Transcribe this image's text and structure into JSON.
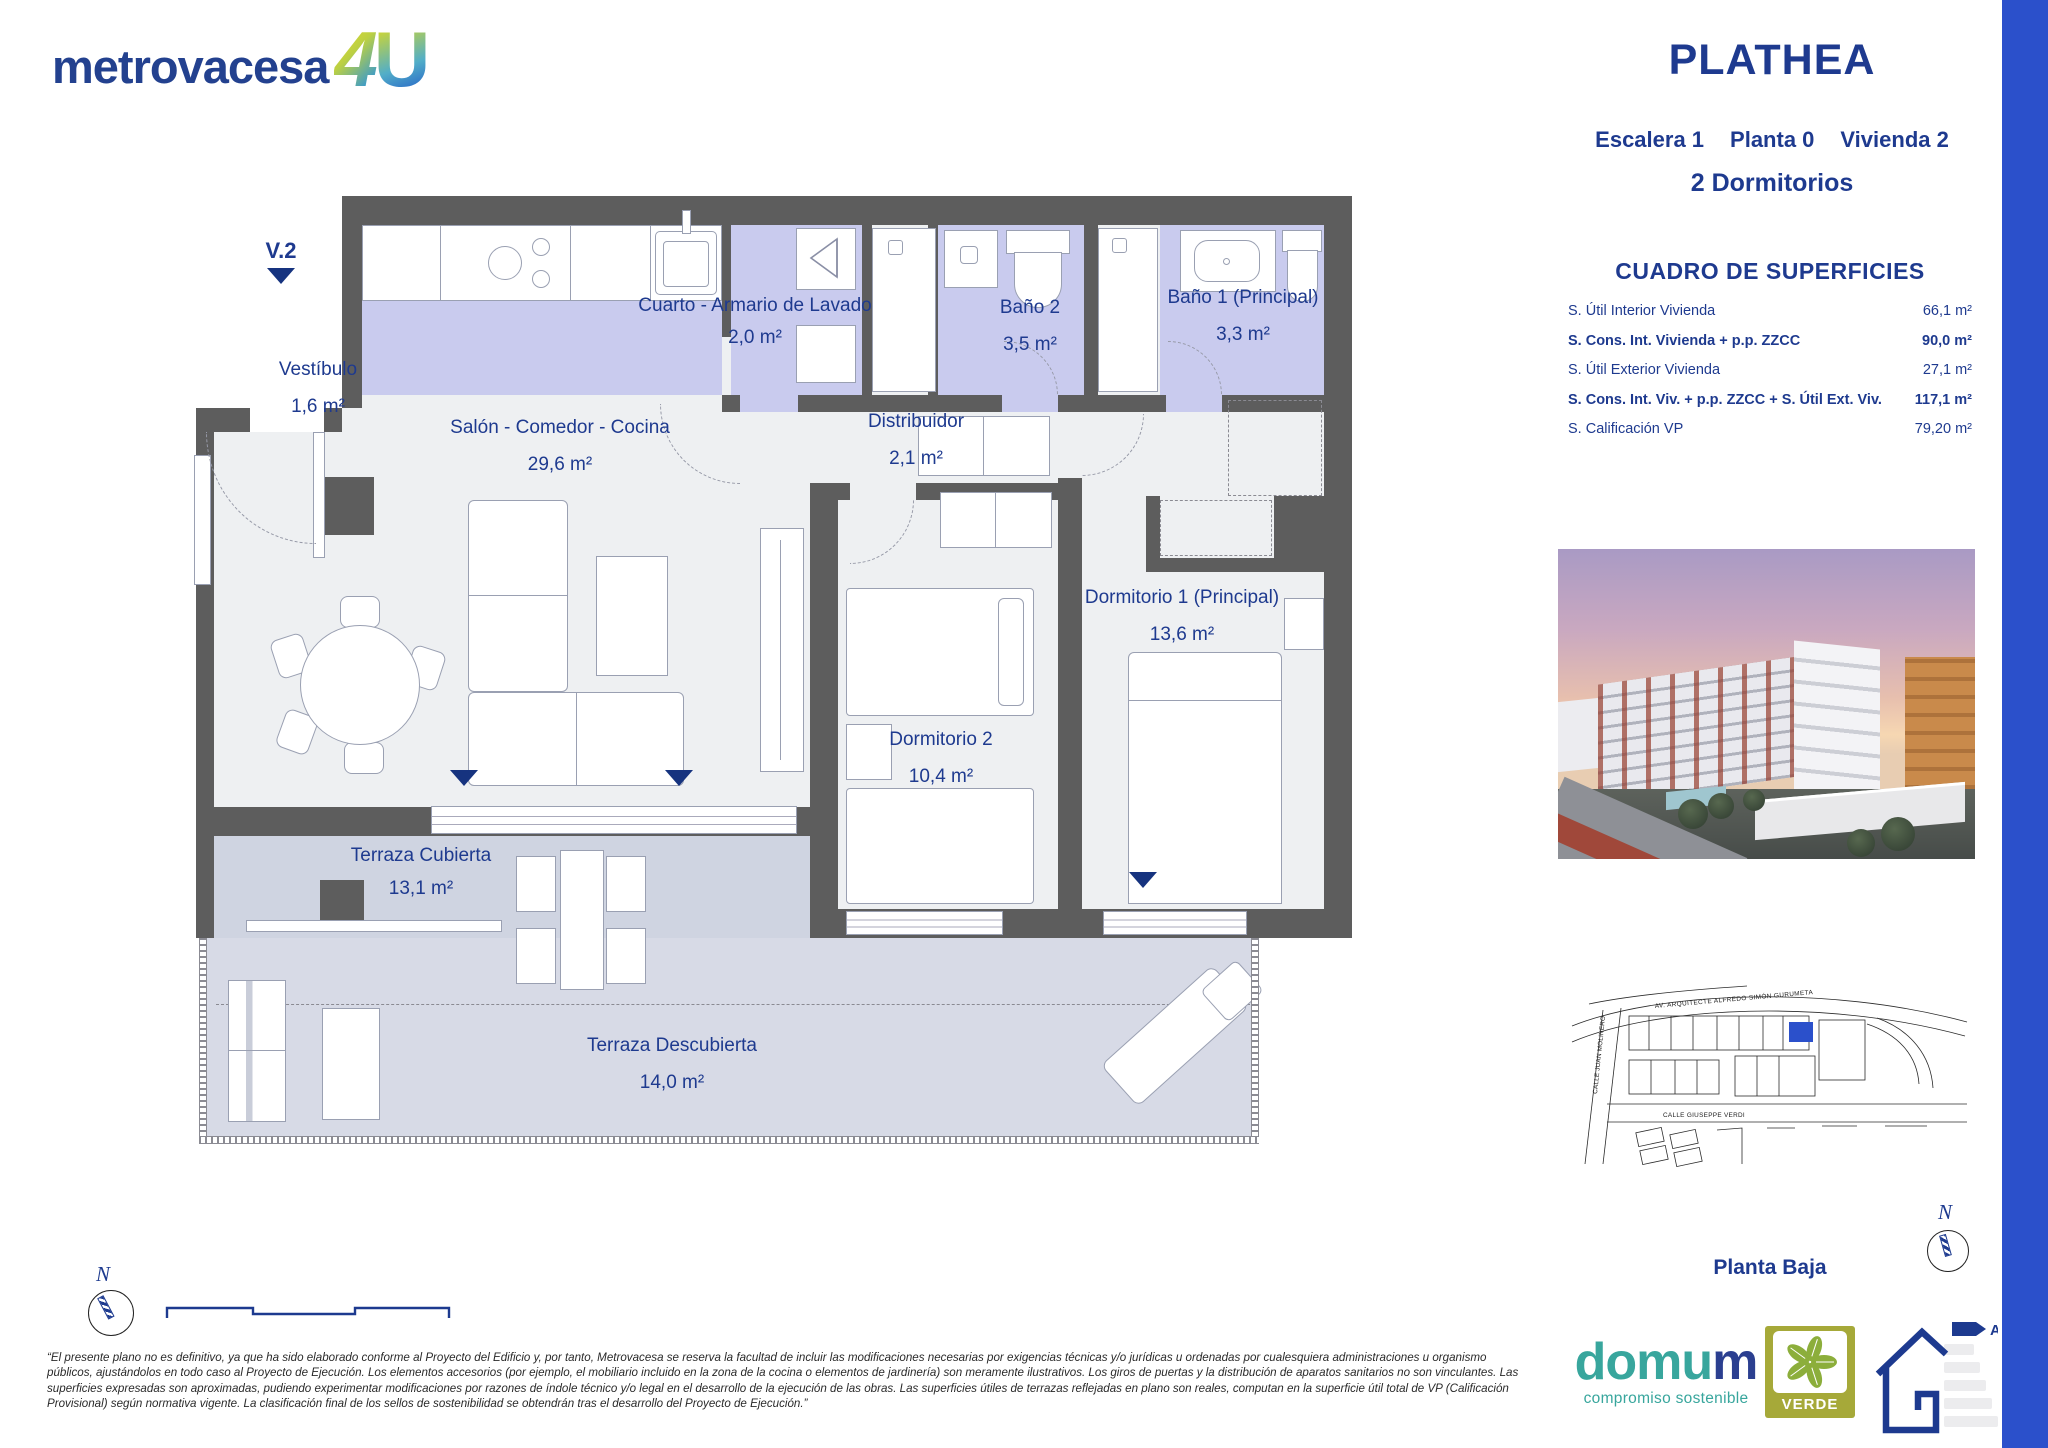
{
  "brand": {
    "logo_main": "metrovacesa",
    "logo_4": "4",
    "logo_u": "U"
  },
  "title_block": {
    "project": "PLATHEA",
    "unit_escalera": "Escalera 1",
    "unit_planta": "Planta 0",
    "unit_vivienda": "Vivienda 2",
    "bedrooms": "2 Dormitorios"
  },
  "surfaces": {
    "title": "CUADRO DE SUPERFICIES",
    "rows": [
      {
        "label": "S. Útil Interior Vivienda",
        "value": "66,1 m²",
        "bold": false
      },
      {
        "label": "S. Cons. Int. Vivienda + p.p. ZZCC",
        "value": "90,0 m²",
        "bold": true
      },
      {
        "label": "S. Útil Exterior Vivienda",
        "value": "27,1 m²",
        "bold": false
      },
      {
        "label": "S. Cons. Int. Viv. + p.p. ZZCC + S. Útil Ext. Viv.",
        "value": "117,1 m²",
        "bold": true
      },
      {
        "label": "S. Calificación VP",
        "value": "79,20 m²",
        "bold": false
      }
    ]
  },
  "floor_plan": {
    "entrance_label": "V.2",
    "rooms": [
      {
        "id": "vestibulo",
        "name": "Vestíbulo",
        "area": "1,6 m²"
      },
      {
        "id": "salon",
        "name": "Salón - Comedor - Cocina",
        "area": "29,6 m²"
      },
      {
        "id": "lavado",
        "name": "Cuarto - Armario de Lavado",
        "area": "2,0 m²"
      },
      {
        "id": "distribuidor",
        "name": "Distribuidor",
        "area": "2,1 m²"
      },
      {
        "id": "bano2",
        "name": "Baño 2",
        "area": "3,5 m²"
      },
      {
        "id": "bano1",
        "name": "Baño 1 (Principal)",
        "area": "3,3 m²"
      },
      {
        "id": "dormitorio1",
        "name": "Dormitorio 1 (Principal)",
        "area": "13,6 m²"
      },
      {
        "id": "dormitorio2",
        "name": "Dormitorio 2",
        "area": "10,4 m²"
      },
      {
        "id": "terraza_cubierta",
        "name": "Terraza Cubierta",
        "area": "13,1 m²"
      },
      {
        "id": "terraza_descubierta",
        "name": "Terraza Descubierta",
        "area": "14,0 m²"
      }
    ]
  },
  "site_plan": {
    "streets": [
      "AV. ARQUITECTE ALFREDO SIMÓN GURUMETA",
      "CALLE JUAN MOLINERO",
      "CALLE GIUSEPPE VERDI"
    ],
    "floor_label": "Planta Baja"
  },
  "compass": {
    "north_label": "N"
  },
  "footer": {
    "disclaimer": "“El presente plano no es definitivo, ya que ha sido elaborado conforme al Proyecto del Edificio y, por tanto, Metrovacesa se reserva la facultad de incluir las modificaciones necesarias por exigencias técnicas y/o jurídicas u ordenadas por cualesquiera administraciones u organismo públicos, ajustándolos en todo caso al Proyecto de Ejecución. Los elementos accesorios (por ejemplo, el mobiliario incluido en la zona de la cocina o elementos de jardinería) son meramente ilustrativos. Los giros de puertas y la distribución de aparatos sanitarios no son vinculantes. Las superficies expresadas son aproximadas, pudiendo experimentar modificaciones por razones de índole técnico y/o legal en el desarrollo de la ejecución de las obras. Las superficies útiles de terrazas reflejadas en plano son reales, computan en la superficie útil total de VP (Calificación Provisional) según normativa vigente. La clasificación final de los sellos de sostenibilidad se obtendrán tras el desarrollo del Proyecto de Ejecución.”",
    "domum_name": "domum",
    "domum_name_head": "domu",
    "domum_name_tail": "m",
    "domum_tagline": "compromiso sostenible",
    "verde_label": "VERDE",
    "energy_rating": "A"
  },
  "colors": {
    "navy": "#1e3a8f",
    "accent_bar": "#2b50cb",
    "wet_room": "#c9cbee",
    "terrace": "#d3d7e3",
    "wall": "#5d5d5d",
    "teal": "#38a69d",
    "olive": "#a6a939"
  }
}
